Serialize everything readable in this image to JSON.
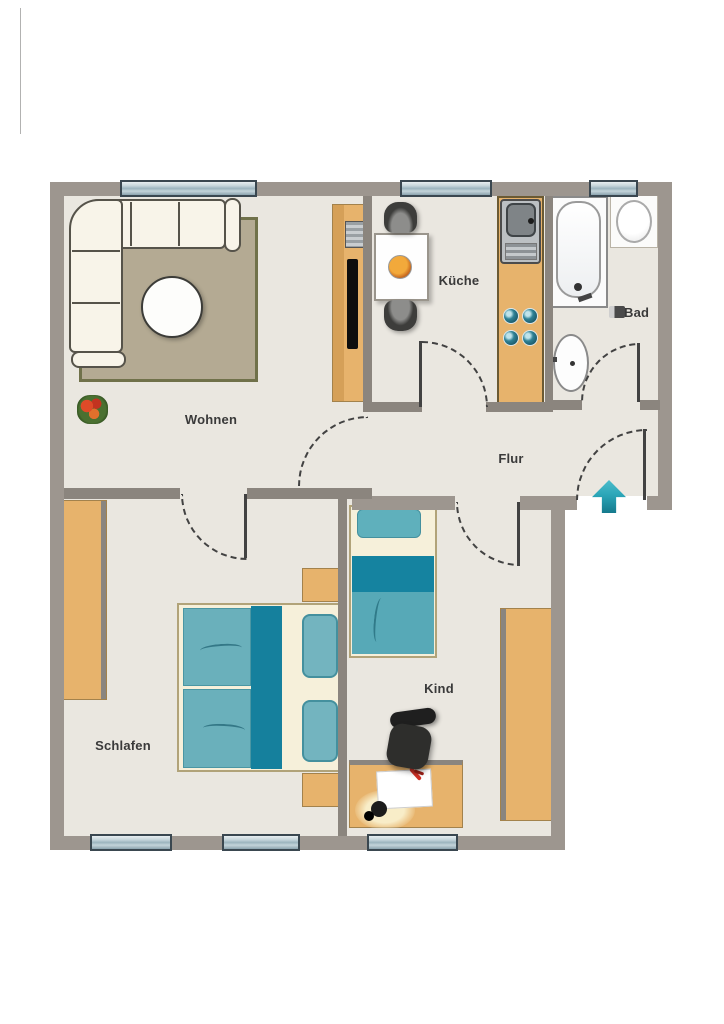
{
  "title": "Apartment floor plan",
  "rooms": {
    "wohnen": {
      "label": "Wohnen"
    },
    "kueche": {
      "label": "Küche"
    },
    "bad": {
      "label": "Bad"
    },
    "flur": {
      "label": "Flur"
    },
    "schlafen": {
      "label": "Schlafen"
    },
    "kind": {
      "label": "Kind"
    }
  },
  "entrance": {
    "symbol": "arrow-up"
  },
  "colors": {
    "wall_outer": "#9d968f",
    "wall_inner": "#8b857e",
    "floor": "#eae7e0",
    "furniture_wood": "#e7b36c",
    "bed_teal": "#6ab0bb",
    "bed_teal_dark": "#15809d",
    "window_glass": "#b9cdd5",
    "window_frame": "#3a4750",
    "arrow_teal": "#2ba6b8",
    "rug": "#b4aa93",
    "sofa_cream": "#f8f4e9"
  }
}
